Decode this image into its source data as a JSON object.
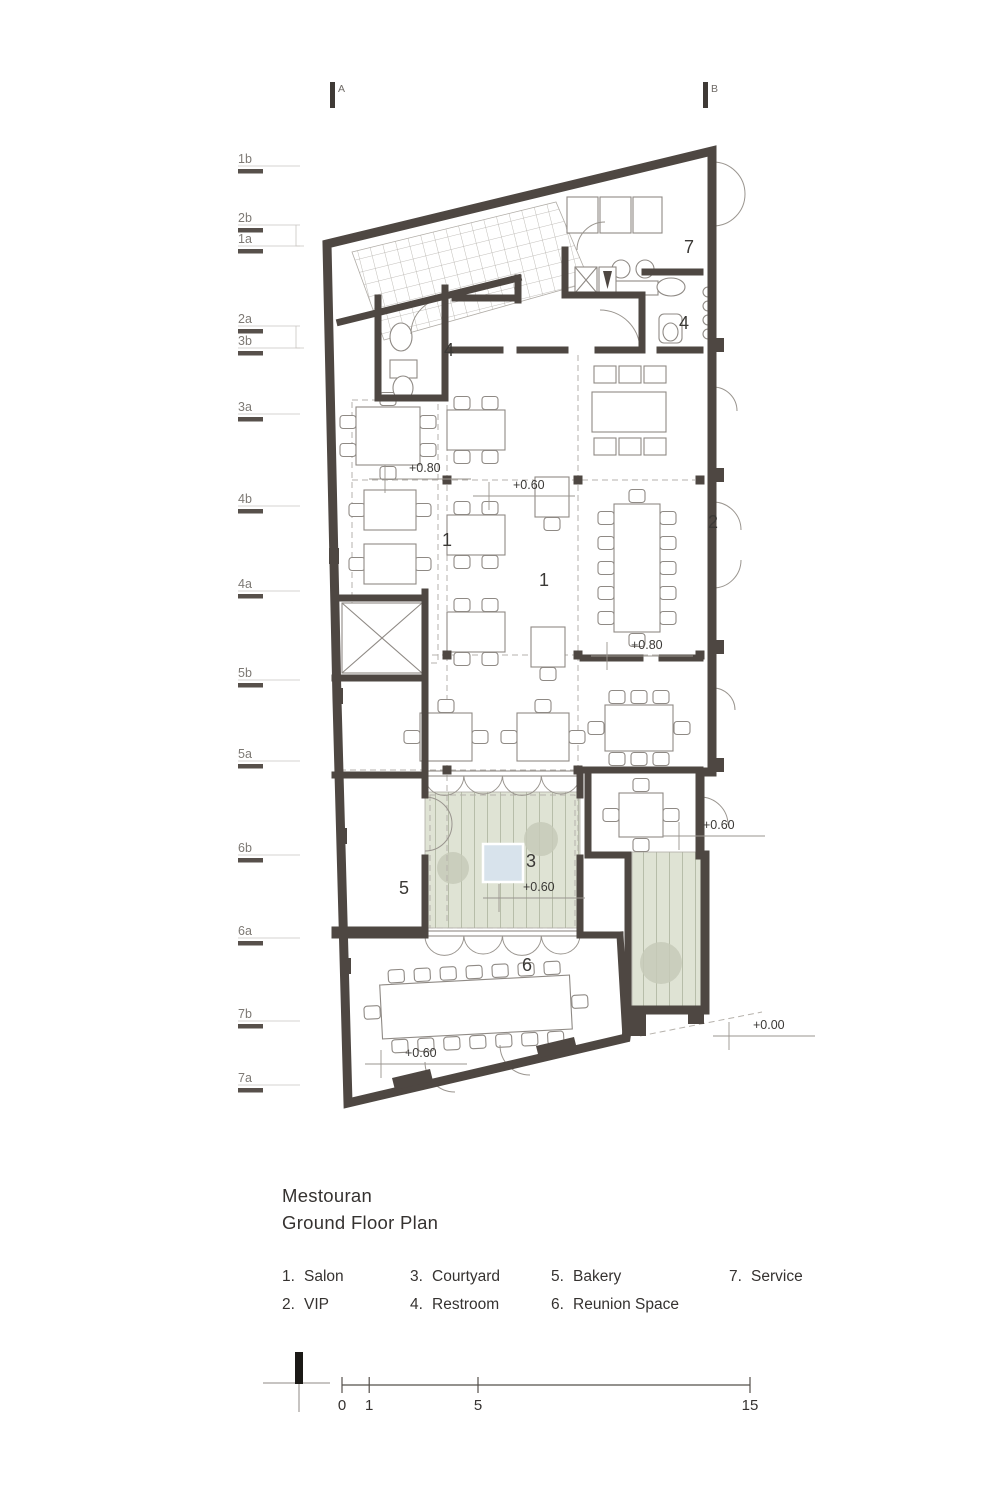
{
  "sheet": {
    "project_title": "Mestouran",
    "drawing_title": "Ground Floor Plan"
  },
  "section_markers": [
    {
      "label": "A",
      "x": 330
    },
    {
      "label": "B",
      "x": 703
    }
  ],
  "grid_labels": [
    {
      "label": "1b",
      "y": 163
    },
    {
      "label": "2b",
      "y": 222,
      "bracket_with_next": true
    },
    {
      "label": "1a",
      "y": 243
    },
    {
      "label": "2a",
      "y": 323,
      "bracket_with_next": true
    },
    {
      "label": "3b",
      "y": 345
    },
    {
      "label": "3a",
      "y": 411
    },
    {
      "label": "4b",
      "y": 503
    },
    {
      "label": "4a",
      "y": 588
    },
    {
      "label": "5b",
      "y": 677
    },
    {
      "label": "5a",
      "y": 758
    },
    {
      "label": "6b",
      "y": 852
    },
    {
      "label": "6a",
      "y": 935
    },
    {
      "label": "7b",
      "y": 1018
    },
    {
      "label": "7a",
      "y": 1082
    }
  ],
  "room_labels": [
    {
      "num": "7",
      "x": 689,
      "y": 253
    },
    {
      "num": "4",
      "x": 684,
      "y": 329
    },
    {
      "num": "4",
      "x": 449,
      "y": 356
    },
    {
      "num": "1",
      "x": 447,
      "y": 546
    },
    {
      "num": "1",
      "x": 544,
      "y": 586
    },
    {
      "num": "2",
      "x": 713,
      "y": 528
    },
    {
      "num": "3",
      "x": 531,
      "y": 867
    },
    {
      "num": "5",
      "x": 404,
      "y": 894
    },
    {
      "num": "6",
      "x": 527,
      "y": 971
    }
  ],
  "elevation_markers": [
    {
      "label": "+0.80",
      "x": 409,
      "y": 472
    },
    {
      "label": "+0.60",
      "x": 513,
      "y": 489
    },
    {
      "label": "+0.80",
      "x": 631,
      "y": 649
    },
    {
      "label": "+0.60",
      "x": 703,
      "y": 829
    },
    {
      "label": "+0.60",
      "x": 523,
      "y": 891
    },
    {
      "label": "+0.60",
      "x": 405,
      "y": 1057
    },
    {
      "label": "+0.00",
      "x": 753,
      "y": 1029
    }
  ],
  "legend_columns": [
    [
      {
        "num": "1.",
        "name": "Salon"
      },
      {
        "num": "2.",
        "name": "VIP"
      }
    ],
    [
      {
        "num": "3.",
        "name": "Courtyard"
      },
      {
        "num": "4.",
        "name": "Restroom"
      }
    ],
    [
      {
        "num": "5.",
        "name": "Bakery"
      },
      {
        "num": "6.",
        "name": "Reunion Space"
      }
    ],
    [
      {
        "num": "7.",
        "name": "Service"
      }
    ]
  ],
  "scale_bar": {
    "tick_values": [
      0,
      1,
      5,
      15
    ],
    "tick_labels": [
      "0",
      "1",
      "5",
      "15"
    ]
  },
  "colors": {
    "wall": "#4e4742",
    "thin_line": "#8f8a85",
    "dashed_line": "#b6b2ac",
    "courtyard_fill": "#dfe3d4",
    "courtyard_stripe": "#b7bda9",
    "tree": "#c7cab8",
    "pool": "#d8e3ec",
    "text_dark": "#3b3936",
    "text_gray": "#7d7974"
  }
}
